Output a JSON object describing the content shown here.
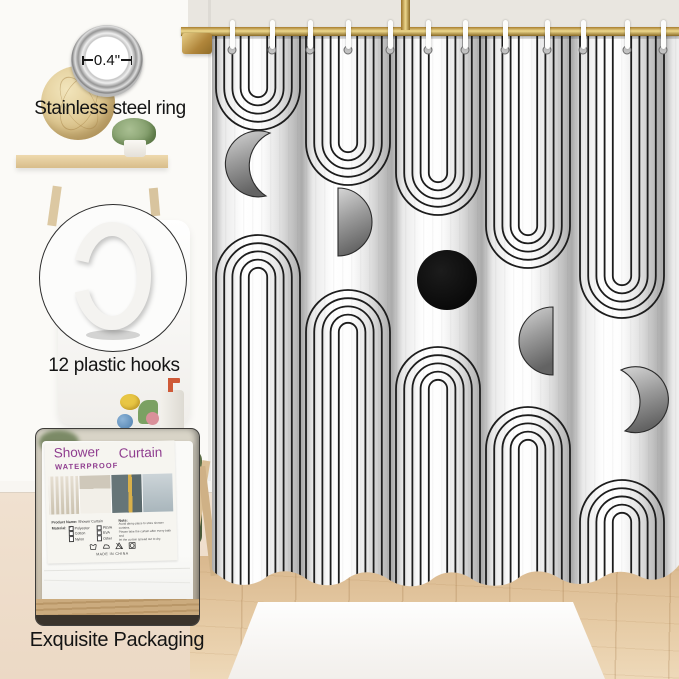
{
  "meta": {
    "subject": "Boho arch and moon-phase shower curtain product photo"
  },
  "annotations": {
    "ring": {
      "measurement": "0.4\"",
      "label": "Stainless steel ring",
      "icon": "steel-ring-grommet"
    },
    "hooks": {
      "label": "12 plastic hooks",
      "icon": "plastic-c-hook",
      "count": 12
    },
    "packaging": {
      "label": "Exquisite Packaging",
      "icon": "packaged-curtain-photo"
    }
  },
  "package_label": {
    "title_word1": "Shower",
    "title_word2": "Curtain",
    "waterproof": "WATERPROOF",
    "product_name_label": "Product Name:",
    "product_name_value": "Shower Curtain",
    "material_label": "Material:",
    "materials": [
      {
        "name": "Polyester",
        "checked": true
      },
      {
        "name": "Cotton",
        "checked": false
      },
      {
        "name": "Nylon",
        "checked": false
      },
      {
        "name": "PEVA",
        "checked": false
      },
      {
        "name": "EVA",
        "checked": false
      },
      {
        "name": "Other",
        "checked": false
      }
    ],
    "note_label": "Note:",
    "note_lines": [
      "Avoid damp place to store shower curtains.",
      "Please take the curtain after every bath and",
      "let the curtain spread out to dry."
    ],
    "made_in": "MADE IN CHINA",
    "care_icons": [
      "wash-icon",
      "iron-icon",
      "no-bleach-icon",
      "dry-icon"
    ]
  },
  "curtain": {
    "pattern": "concentric black line arches with gray moon phases on white fabric",
    "shapes": [
      "arch-down",
      "crescent-moon-right",
      "arch-up",
      "half-moon",
      "full-moon-black",
      "crescent-moon-left"
    ],
    "hook_count": 12
  },
  "colors": {
    "accent_magenta": "#8f3d8f",
    "rod_gold": "#c79a4b",
    "curtain_line": "#1d1d1d",
    "moon_gray": "#8a8a8a",
    "floor_wood": "#e2c096",
    "wall": "#eae7e1"
  }
}
